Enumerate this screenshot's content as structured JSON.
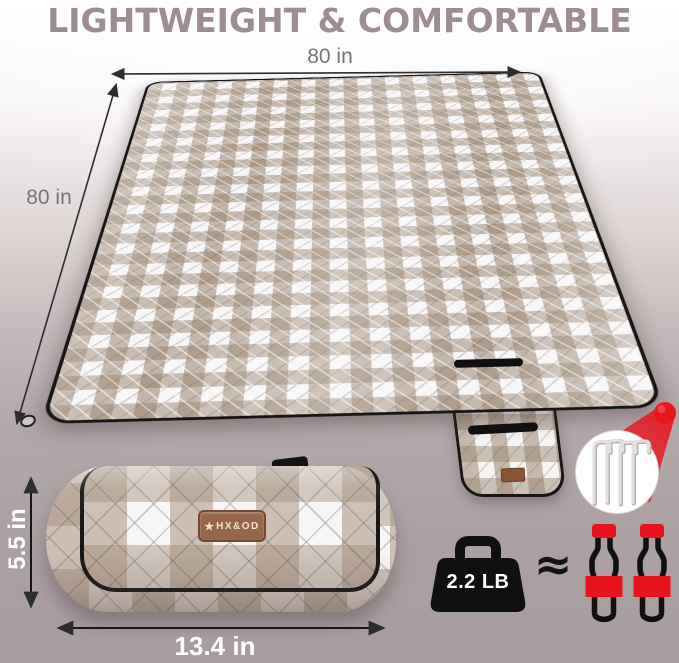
{
  "title": {
    "text": "LIGHTWEIGHT & COMFORTABLE",
    "color": "#9c8c93"
  },
  "blanket": {
    "top_width_label": "80 in",
    "side_length_label": "80 in",
    "colors": {
      "check_tan": "#a8917c",
      "check_white": "#f7f5f6",
      "trim_black": "#161616"
    },
    "corner_marker_color": "#e8161d",
    "callout": {
      "icon": "ground-stakes-icon",
      "stake_count": 4
    }
  },
  "roll": {
    "height_label": "5.5 in",
    "width_label": "13.4 in",
    "brand_label": {
      "star": "★",
      "text": "HX&OD",
      "patch_color": "#96664a"
    }
  },
  "weight": {
    "badge_label": "2.2 LB",
    "approx_symbol": "≈",
    "bottle_count": 2,
    "accent_red": "#e8131d"
  }
}
